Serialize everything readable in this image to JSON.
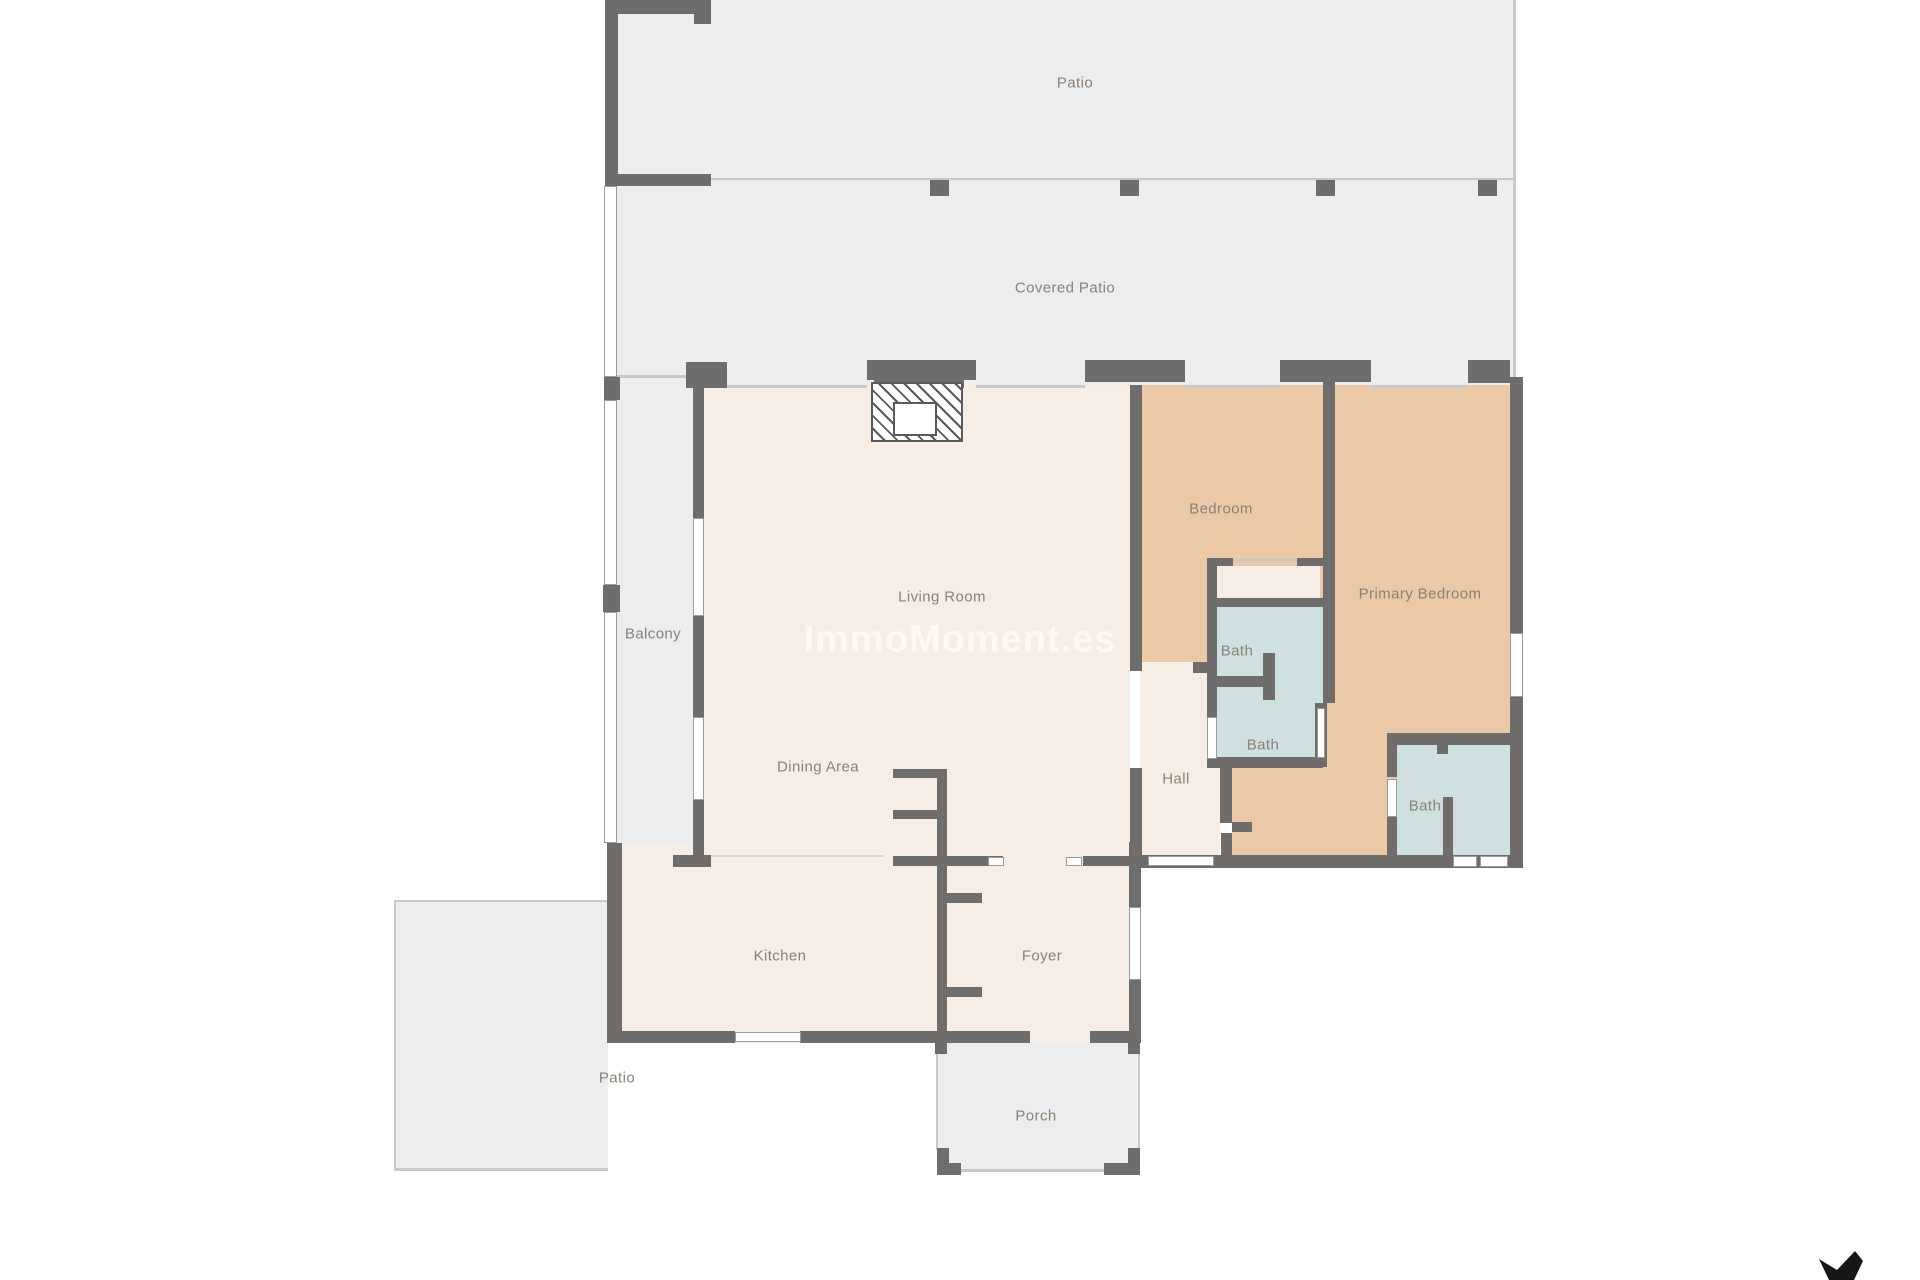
{
  "watermark": {
    "text": "ImmoMoment.es",
    "color": "rgba(255,255,255,0.62)"
  },
  "branding": {
    "logo_icon": "immomoment-bird-logo",
    "logo_color": "#161616"
  },
  "rooms": {
    "patio_top": {
      "label": "Patio"
    },
    "covered_patio": {
      "label": "Covered Patio"
    },
    "balcony": {
      "label": "Balcony"
    },
    "living_room": {
      "label": "Living Room"
    },
    "dining_area": {
      "label": "Dining Area"
    },
    "kitchen": {
      "label": "Kitchen"
    },
    "foyer": {
      "label": "Foyer"
    },
    "hall": {
      "label": "Hall"
    },
    "bedroom": {
      "label": "Bedroom"
    },
    "primary_bedroom": {
      "label": "Primary Bedroom"
    },
    "bath_upper": {
      "label": "Bath"
    },
    "bath_middle": {
      "label": "Bath"
    },
    "bath_lower": {
      "label": "Bath"
    },
    "porch": {
      "label": "Porch"
    },
    "patio_lower": {
      "label": "Patio"
    }
  },
  "colors": {
    "outdoor_floor": "#ebedee",
    "indoor_floor": "#f6ede7",
    "bedroom_floor": "#ecc9a6",
    "bath_floor": "#cfe0e1",
    "wall": "#6e6d6b",
    "label_text": "#8b8177"
  }
}
